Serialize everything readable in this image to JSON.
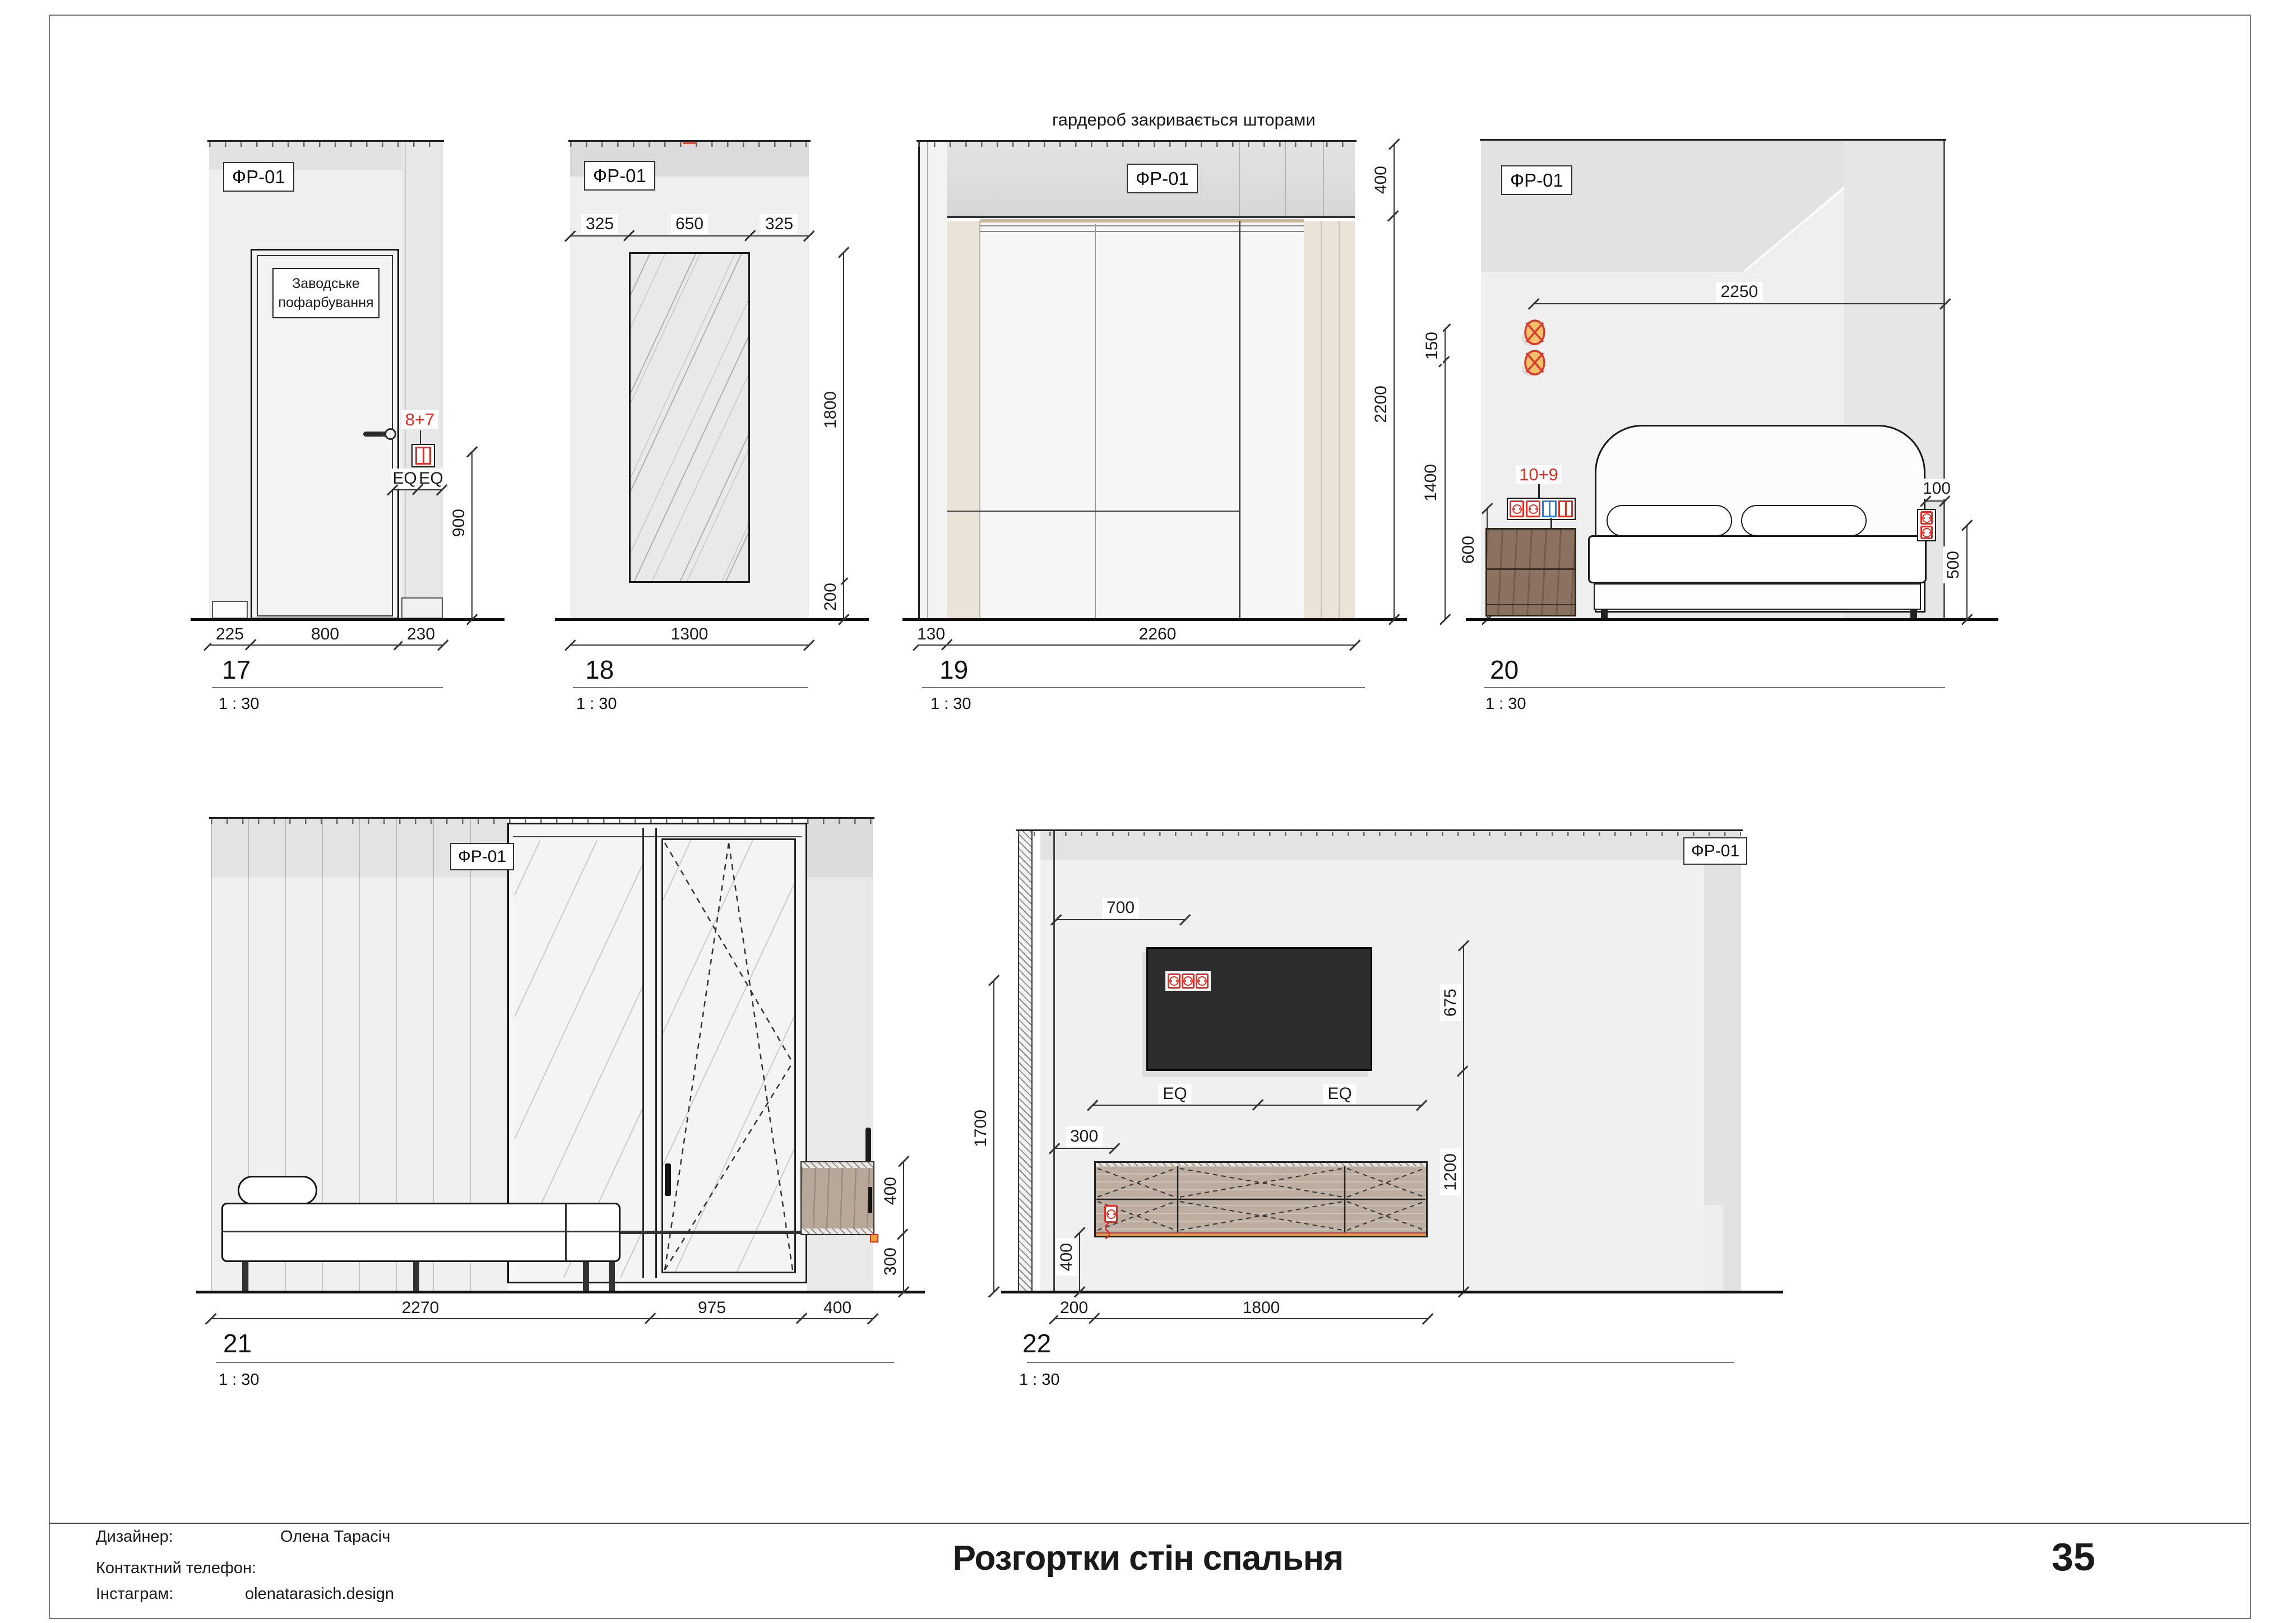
{
  "colors": {
    "annotation_red": "#d92f27",
    "switch_blue": "#2f7bd4",
    "sconce_orange": "#f3c169",
    "wood_dark": "#8a7160",
    "wood_light": "#bcada0",
    "tv_black": "#2d2d2d",
    "wall_gray": "#efefef"
  },
  "finish_tag": "ФР-01",
  "views": {
    "v17": {
      "number": "17",
      "scale": "1 : 30",
      "door_note_1": "Заводське",
      "door_note_2": "пофарбування",
      "socket_tag": "8+7",
      "eq": [
        "EQ",
        "EQ"
      ],
      "dim_900": "900",
      "dims_bottom": [
        "225",
        "800",
        "230"
      ]
    },
    "v18": {
      "number": "18",
      "scale": "1 : 30",
      "dims_top": [
        "325",
        "650",
        "325"
      ],
      "dim_1800": "1800",
      "dim_200": "200",
      "dim_bottom": "1300"
    },
    "v19": {
      "number": "19",
      "scale": "1 : 30",
      "caption": "гардероб закривається шторами",
      "dim_400": "400",
      "dim_2200": "2200",
      "dims_bottom": [
        "130",
        "2260"
      ]
    },
    "v20": {
      "number": "20",
      "scale": "1 : 30",
      "dim_2250": "2250",
      "dim_150": "150",
      "dim_1400": "1400",
      "dim_600": "600",
      "socket_tag_top": "10+9",
      "socket_tag_bottom": "7+8",
      "dim_100": "100",
      "dim_500": "500"
    },
    "v21": {
      "number": "21",
      "scale": "1 : 30",
      "dims_bottom": [
        "2270",
        "975",
        "400"
      ],
      "dim_400": "400",
      "dim_300": "300"
    },
    "v22": {
      "number": "22",
      "scale": "1 : 30",
      "dim_700": "700",
      "eq": [
        "EQ",
        "EQ"
      ],
      "dim_1700": "1700",
      "dim_300": "300",
      "dim_400": "400",
      "dim_675": "675",
      "dim_1200": "1200",
      "dims_bottom": [
        "200",
        "1800"
      ]
    }
  },
  "footer": {
    "designer_label": "Дизайнер:",
    "designer_value": "Олена Тарасіч",
    "phone_label": "Контактний телефон:",
    "phone_value": "",
    "instagram_label": "Інстаграм:",
    "instagram_value": "olenatarasich.design",
    "sheet_title": "Розгортки стін спальня",
    "page_number": "35"
  }
}
